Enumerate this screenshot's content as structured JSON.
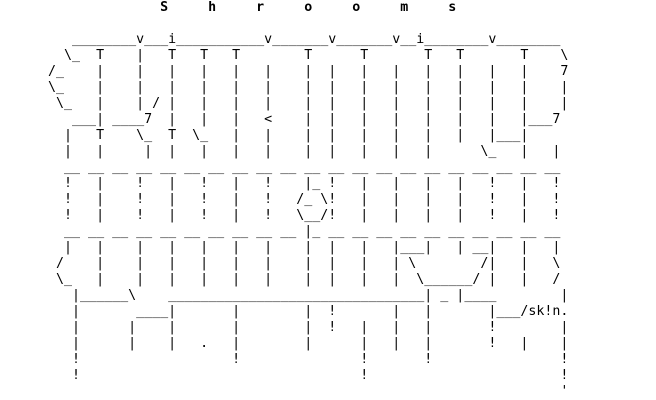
{
  "title": "Shrooms",
  "signature": "sk!n",
  "colors": {
    "background": "#ffffff",
    "foreground": "#000000"
  },
  "art": {
    "rows": [
      "                    S     h     r     o     o     m     s",
      "",
      "         ________v___i___________v_______v_______v__i________v________",
      "        \\_  T    |   T   T   T        T      T       T   T       T    \\",
      "      /_    |    |   |   |   |   |    |  |   |   |   |   |   |   |    7",
      "      \\_    |    |   |   |   |   |    |  |   |   |   |   |   |   |    |",
      "       \\_   |    | / |   |   |   |    |  |   |   |   |   |   |   |    |",
      "         ___| ____7  |   |   |   <    |  |   |   |   |   |   |   |___7",
      "        |   T    \\_  T  \\_   |   |    |  |   |   |   |   |   |___|",
      "        |   |     |  |   |   |   |    |  |   |   |   |      \\_   |   |",
      "        __ __ __ __ __ __ __ __ __ __ __ __ __ __ __ __ __ __ __ __ __",
      "        !   |    !   |   !   |   !    |_ !   |   |   |   |   !   |   !",
      "        !   |    !   |   !   |   !   /_ \\!   |   |   |   |   !   |   !",
      "        !   |    !   |   !   |   !   \\__/!   |   |   |   |   !   |   !",
      "        __ __ __ __ __ __ __ __ __ __ |_ __ __ __ __ __ __ __ __ __ __",
      "        |   |    |   |   |   |   |    |  |   |   |___|   | __|   |   |",
      "       /    |    |   |   |   |   |    |  |   |   | \\        /|   |   \\",
      "       \\_   |    |   |   |   |   |    |  |   |   |  \\______/ |   |   /",
      "         |______\\    ________________________________| _ |____        |",
      "         |       ____|       |        |  !       |   |       |___/sk!n.",
      "         |      |    |       |        |  !   |   |   |       !        |",
      "         |      |    |   .   |        |      |   |   |       !   |    |",
      "         !                   !               !       !                !",
      "         !                                   !                        !",
      "                                                                      '"
    ]
  }
}
